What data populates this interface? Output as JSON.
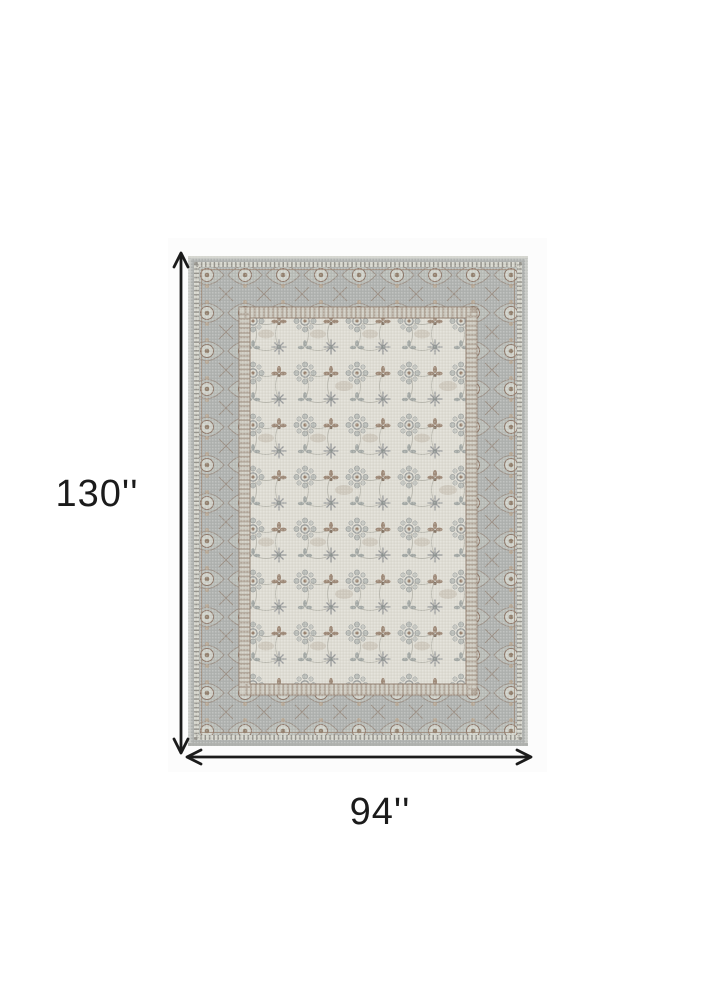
{
  "figure": {
    "height_label": "130''",
    "width_label": "94''",
    "annotation_color": "#1b1b1b",
    "canvas_background": "#ffffff",
    "photo_background": "#fcfcfc"
  },
  "rug": {
    "palette": {
      "outer_edge": "#c9cbc7",
      "border_band": "#afb2af",
      "border_motif_brown": "#8a7363",
      "guard_accent_brown": "#93806f",
      "field_ivory": "#dedcd3",
      "field_motif_gray": "#999c9b",
      "field_motif_brown": "#97806d"
    }
  }
}
